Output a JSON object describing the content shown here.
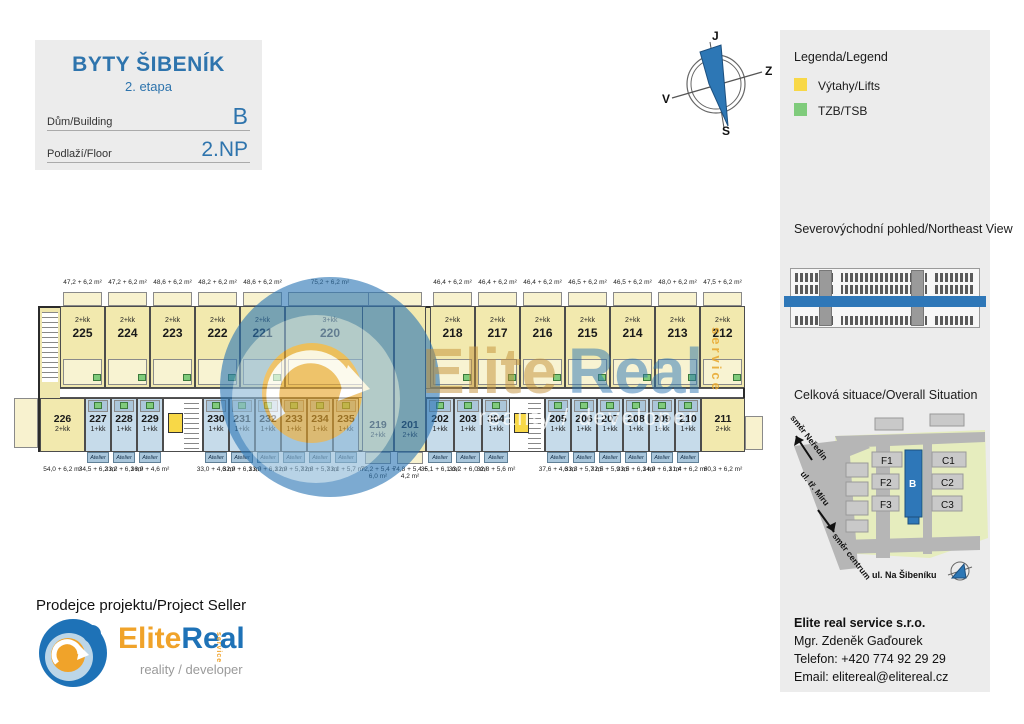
{
  "title_block": {
    "project": "BYTY ŠIBENÍK",
    "stage": "2. etapa",
    "building_label": "Dům/Building",
    "building_value": "B",
    "floor_label": "Podlaží/Floor",
    "floor_value": "2.NP"
  },
  "compass": {
    "top": "J",
    "right": "Z",
    "left": "V",
    "bottom": "S"
  },
  "legend": {
    "title": "Legenda/Legend",
    "items": [
      {
        "label": "Výtahy/Lifts",
        "color": "#f8d847"
      },
      {
        "label": "TZB/TSB",
        "color": "#7fcb7b"
      }
    ]
  },
  "northeast_view": {
    "title": "Severovýchodní pohled/Northeast View",
    "highlight_color": "#2e77b8"
  },
  "situation": {
    "title": "Celková situace/Overall Situation",
    "direction_top": "směr Neředín",
    "street_diagonal": "ul. tř. Míru",
    "direction_bottom": "směr centrum",
    "street_bottom": "ul. Na Šibeníku",
    "buildings": [
      "F1",
      "F2",
      "F3",
      "B",
      "C1",
      "C2",
      "C3"
    ],
    "highlighted_building": "B",
    "highlight_color": "#2e77b8"
  },
  "seller": {
    "heading": "Prodejce projektu/Project Seller",
    "logo_text_1": "Elite",
    "logo_text_2": "Real",
    "logo_service": "service",
    "logo_sub": "reality / developer",
    "company": "Elite real service s.r.o.",
    "contact_name": "Mgr. Zdeněk Gaďourek",
    "phone": "Telefon: +420 774 92 29 29",
    "email": "Email: elitereal@elitereal.cz"
  },
  "watermark": {
    "text_1": "Elite",
    "text_2": "Real",
    "sub": "reality / developer",
    "side": "service"
  },
  "plan": {
    "atelier_label": "Atelier",
    "top_units": [
      {
        "number": "225",
        "type": "2+kk",
        "area": "47,2 + 6,2 m²"
      },
      {
        "number": "224",
        "type": "2+kk",
        "area": "47,2 + 6,2 m²"
      },
      {
        "number": "223",
        "type": "2+kk",
        "area": "48,6 + 6,2 m²"
      },
      {
        "number": "222",
        "type": "2+kk",
        "area": "48,2 + 6,2 m²"
      },
      {
        "number": "221",
        "type": "2+kk",
        "area": "48,6 + 6,2 m²"
      },
      {
        "number": "220",
        "type": "3+kk",
        "area": "75,2 + 6,2 m²"
      },
      {
        "number": "218",
        "type": "2+kk",
        "area": "46,4 + 6,2 m²"
      },
      {
        "number": "217",
        "type": "2+kk",
        "area": "46,4 + 6,2 m²"
      },
      {
        "number": "216",
        "type": "2+kk",
        "area": "46,4 + 6,2 m²"
      },
      {
        "number": "215",
        "type": "2+kk",
        "area": "46,5 + 6,2 m²"
      },
      {
        "number": "214",
        "type": "2+kk",
        "area": "46,5 + 6,2 m²"
      },
      {
        "number": "213",
        "type": "2+kk",
        "area": "48,0 + 6,2 m²"
      },
      {
        "number": "212",
        "type": "2+kk",
        "area": "47,5 + 6,2 m²"
      }
    ],
    "bottom_units": [
      {
        "number": "226",
        "type": "2+kk",
        "area": "54,0 + 6,2 m²",
        "style": "yellow"
      },
      {
        "number": "227",
        "type": "1+kk",
        "area": "34,5 + 6,2 m²",
        "style": "atelier"
      },
      {
        "number": "228",
        "type": "1+kk",
        "area": "33,2 + 6,1 m²",
        "style": "atelier"
      },
      {
        "number": "229",
        "type": "1+kk",
        "area": "36,9 + 4,6 m²",
        "style": "atelier"
      },
      {
        "number": "230",
        "type": "1+kk",
        "area": "33,0 + 4,6 m²",
        "style": "atelier"
      },
      {
        "number": "231",
        "type": "1+kk",
        "area": "32,9 + 6,1 m²",
        "style": "atelier"
      },
      {
        "number": "232",
        "type": "1+kk",
        "area": "33,0 + 6,1 m²",
        "style": "atelier"
      },
      {
        "number": "233",
        "type": "1+kk",
        "area": "32,9 + 5,7 m²",
        "style": "atelier"
      },
      {
        "number": "234",
        "type": "1+kk",
        "area": "32,8 + 5,7 m²",
        "style": "atelier"
      },
      {
        "number": "235",
        "type": "1+kk",
        "area": "33,1 + 5,7 m²",
        "style": "atelier"
      },
      {
        "number": "219",
        "type": "2+kk",
        "area": "72,2 + 5,4 + 6,0 m²",
        "style": "yellow-tall"
      },
      {
        "number": "201",
        "type": "2+kk",
        "area": "74,8 + 5,4 + 4,2 m²",
        "style": "yellow-tall"
      },
      {
        "number": "202",
        "type": "1+kk",
        "area": "35,1 + 6,1 m²",
        "style": "atelier"
      },
      {
        "number": "203",
        "type": "1+kk",
        "area": "33,2 + 6,0 m²",
        "style": "atelier"
      },
      {
        "number": "304",
        "type": "1+kk",
        "area": "32,8 + 5,6 m²",
        "style": "atelier"
      },
      {
        "number": "205",
        "type": "1+kk",
        "area": "37,6 + 4,6 m²",
        "style": "atelier"
      },
      {
        "number": "206",
        "type": "1+kk",
        "area": "33,3 + 5,7 m²",
        "style": "atelier"
      },
      {
        "number": "207",
        "type": "1+kk",
        "area": "32,5 + 5,9 m²",
        "style": "atelier"
      },
      {
        "number": "208",
        "type": "1+kk",
        "area": "33,5 + 6,1 m²",
        "style": "atelier"
      },
      {
        "number": "209",
        "type": "1+kk",
        "area": "34,9 + 6,1 m²",
        "style": "atelier"
      },
      {
        "number": "210",
        "type": "1+kk",
        "area": "31,4 + 6,2 m²",
        "style": "atelier"
      },
      {
        "number": "211",
        "type": "2+kk",
        "area": "60,3 + 6,2 m²",
        "style": "yellow"
      }
    ]
  }
}
